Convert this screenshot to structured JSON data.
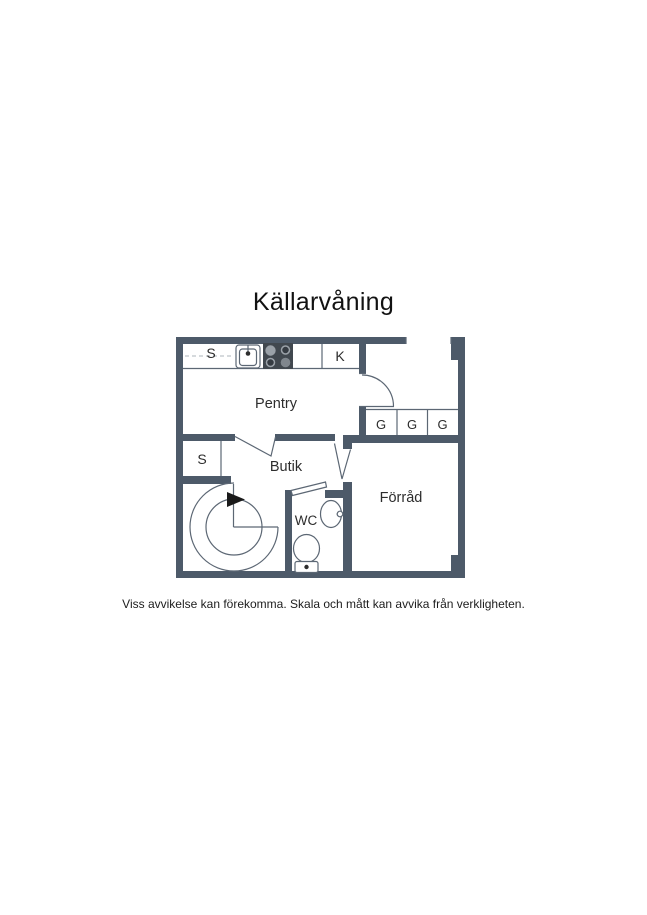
{
  "page": {
    "title": "Källarvåning",
    "disclaimer": "Viss avvikelse kan förekomma. Skala och mått kan avvika från verkligheten."
  },
  "floorplan": {
    "colors": {
      "wall": "#4d5a69",
      "line": "#5c6774",
      "fixture_dark": "#41484f",
      "text": "#2d2d2d"
    },
    "labels": {
      "cabinet_top": "S",
      "fridge": "K",
      "pentry": "Pentry",
      "wardrobe_1": "G",
      "wardrobe_2": "G",
      "wardrobe_3": "G",
      "closet": "S",
      "butik": "Butik",
      "wc": "WC",
      "forrad": "Förråd"
    }
  }
}
